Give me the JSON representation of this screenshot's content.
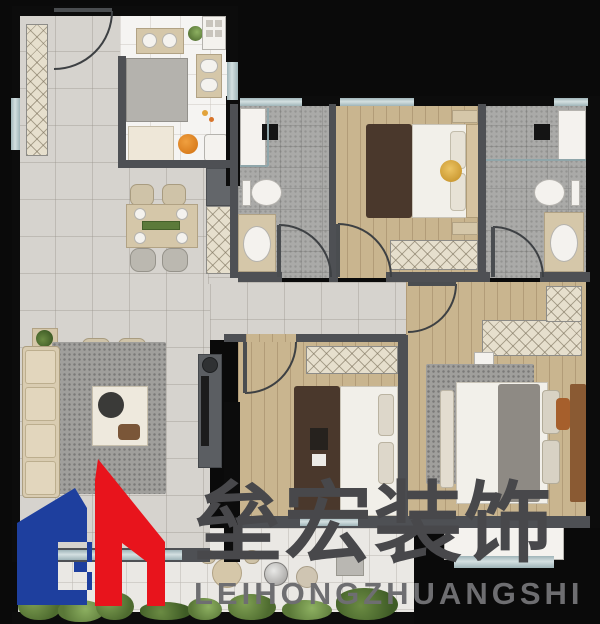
{
  "watermark": {
    "company_name_cn": "垒宏装饰",
    "company_name_en": "LEIHONGZHUANGSHI",
    "logo_monogram": "GH",
    "logo_blue": "#1e3f9e",
    "logo_red": "#e8141c",
    "cn_text_color": "#48484b",
    "en_text_color": "#6e6e71"
  },
  "floorplan": {
    "background_color": "#0a0a0a",
    "floor_colors": {
      "living_dining_tile": "#d6d3ce",
      "kitchen_tile": "#f5f4f2",
      "bathroom_tile": "#aaaaa8",
      "bedroom_wood": "#c9b58f",
      "balcony_tile": "#eae8e4"
    },
    "wall_colors": {
      "interior_wall": "#4e5054",
      "exterior_wall": "#0c0c0c",
      "window_glass": "#b7c6c9"
    },
    "accent_colors": {
      "stool_orange": "#e2831d",
      "plant_green": "#5c7d3f",
      "bed_runner_brown": "#4a382c",
      "bed_lamp_gold": "#d9a83e"
    }
  }
}
